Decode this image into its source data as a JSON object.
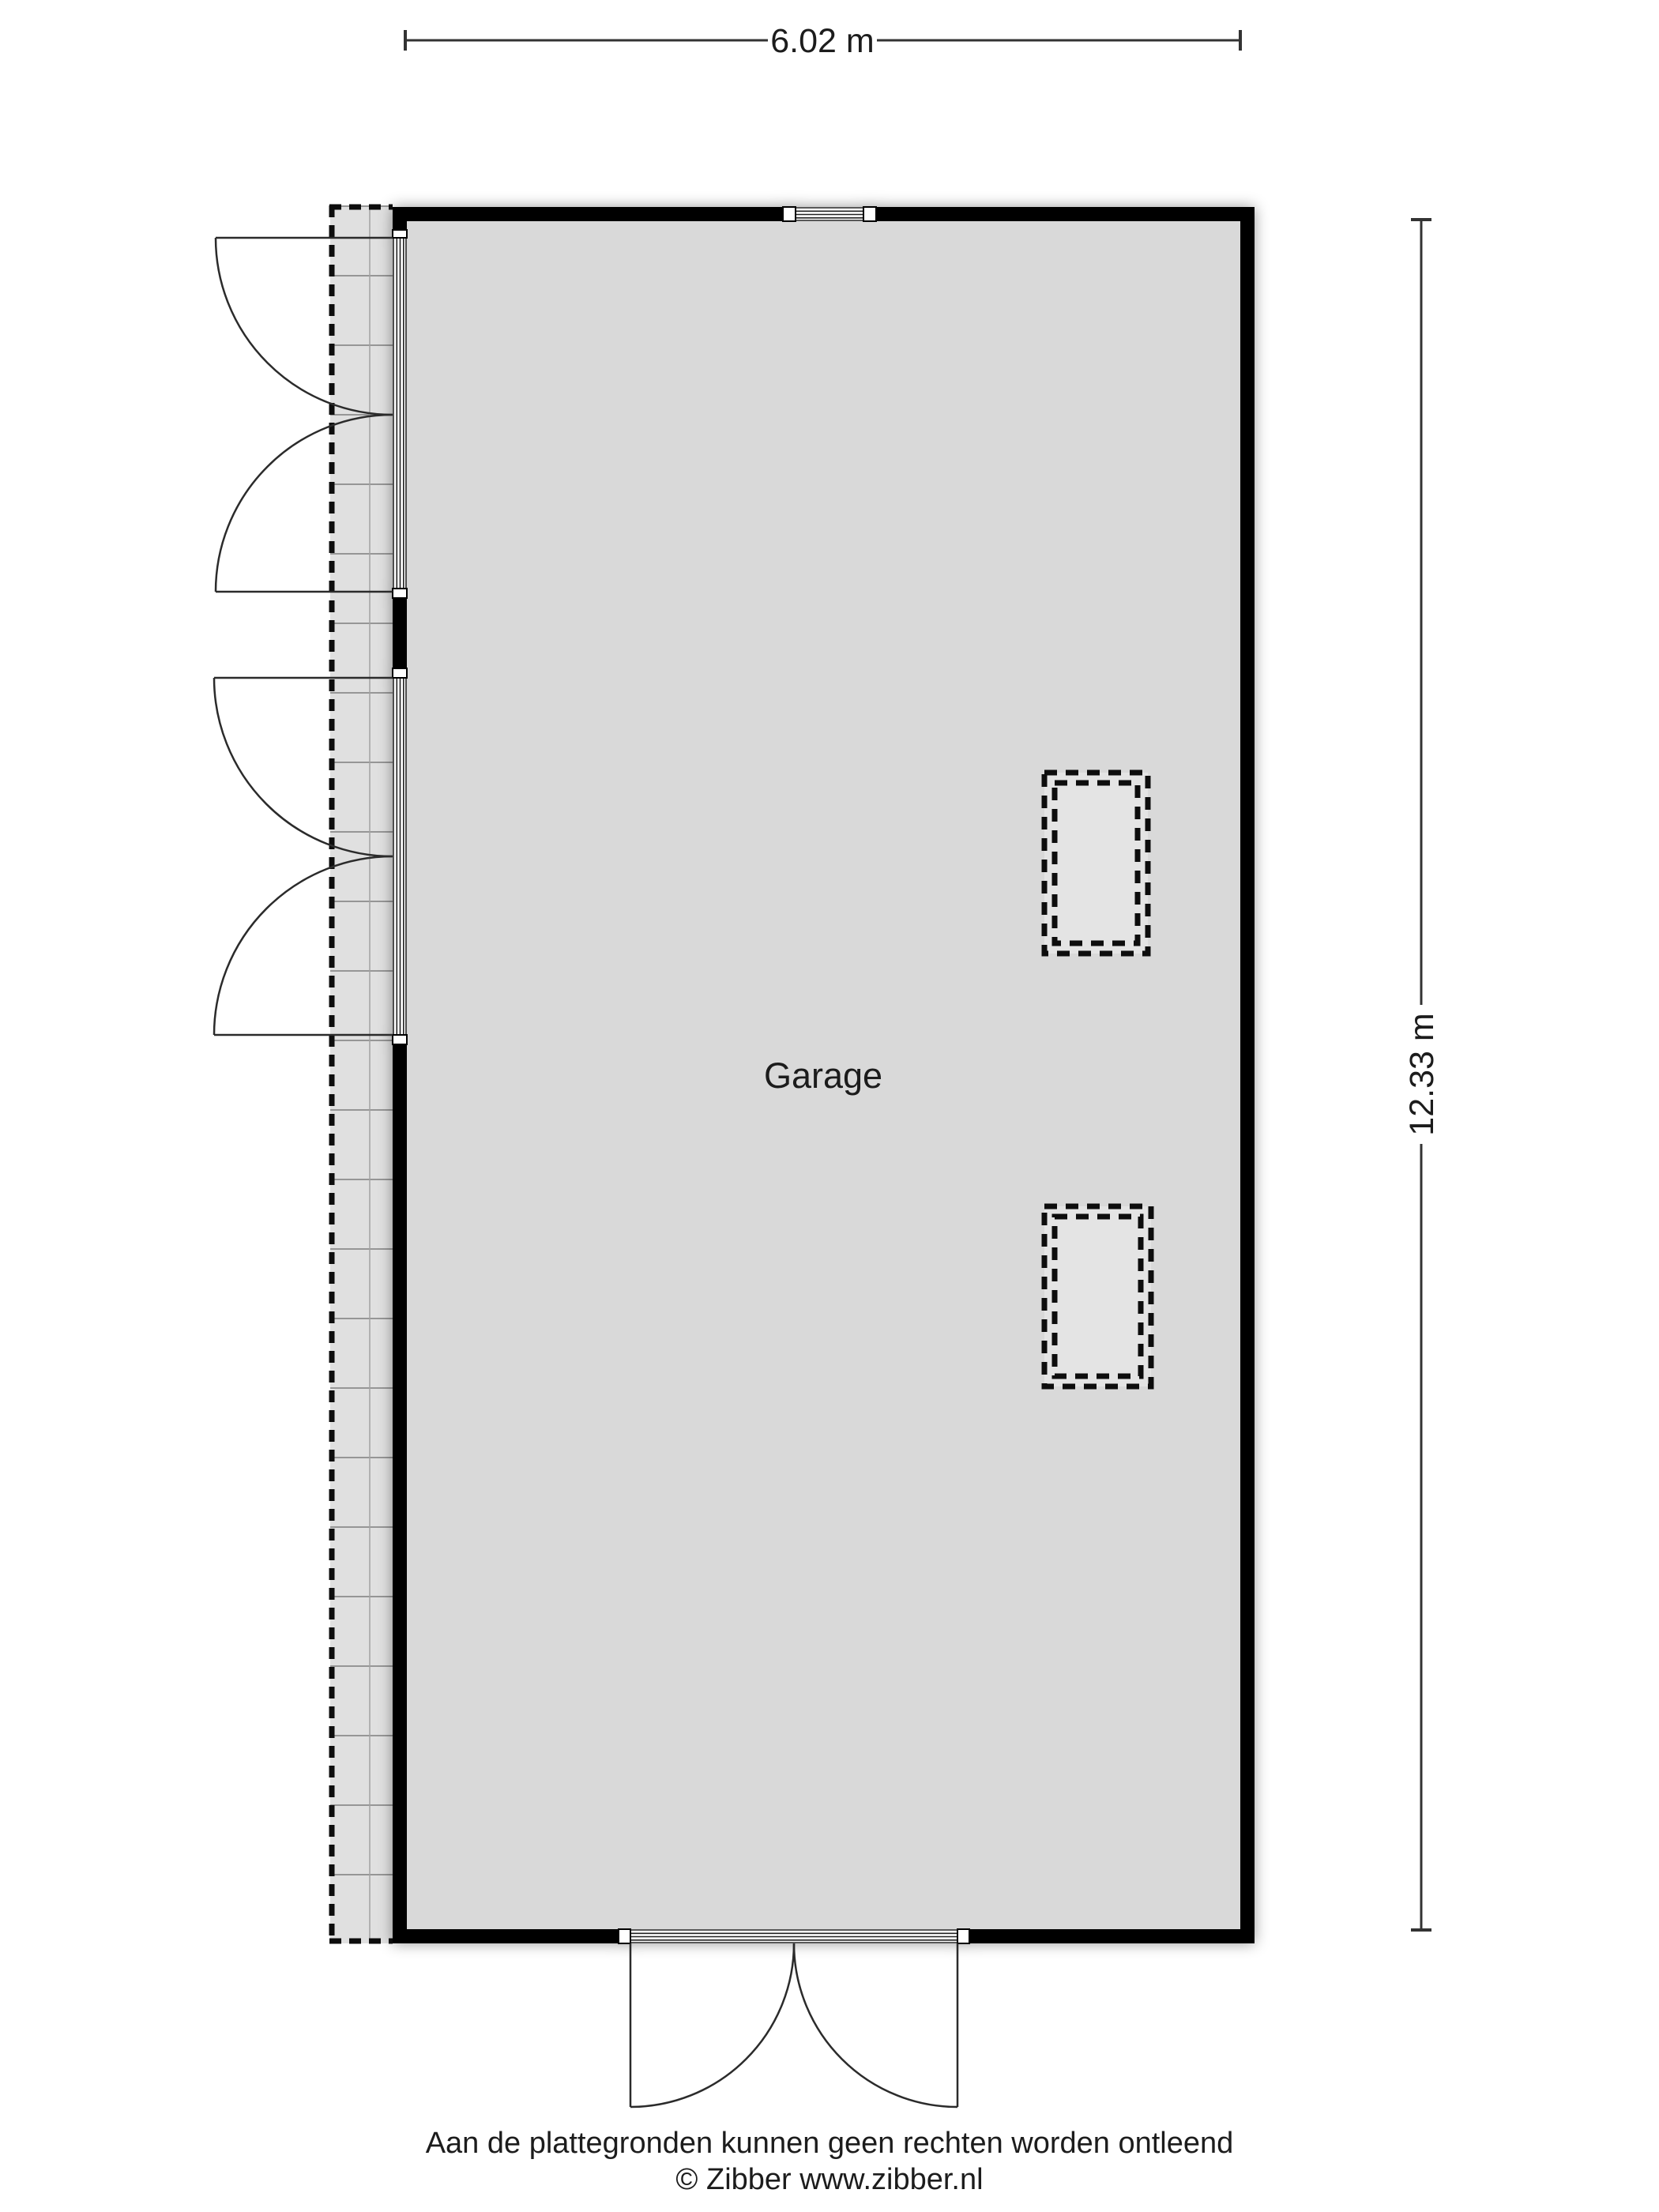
{
  "plan": {
    "room_label": "Garage",
    "dimensions": {
      "width_label": "6.02 m",
      "height_label": "12.33 m"
    }
  },
  "footer": {
    "disclaimer": "Aan de plattegronden kunnen geen rechten worden ontleend",
    "copyright": "© Zibber www.zibber.nl"
  },
  "colors": {
    "room_fill": "#d9d9d9",
    "strip_fill": "#e0e0e0",
    "skylight_fill": "#e4e4e4",
    "wall": "#000000",
    "line": "#2b2b2b",
    "dimension": "#333333"
  }
}
